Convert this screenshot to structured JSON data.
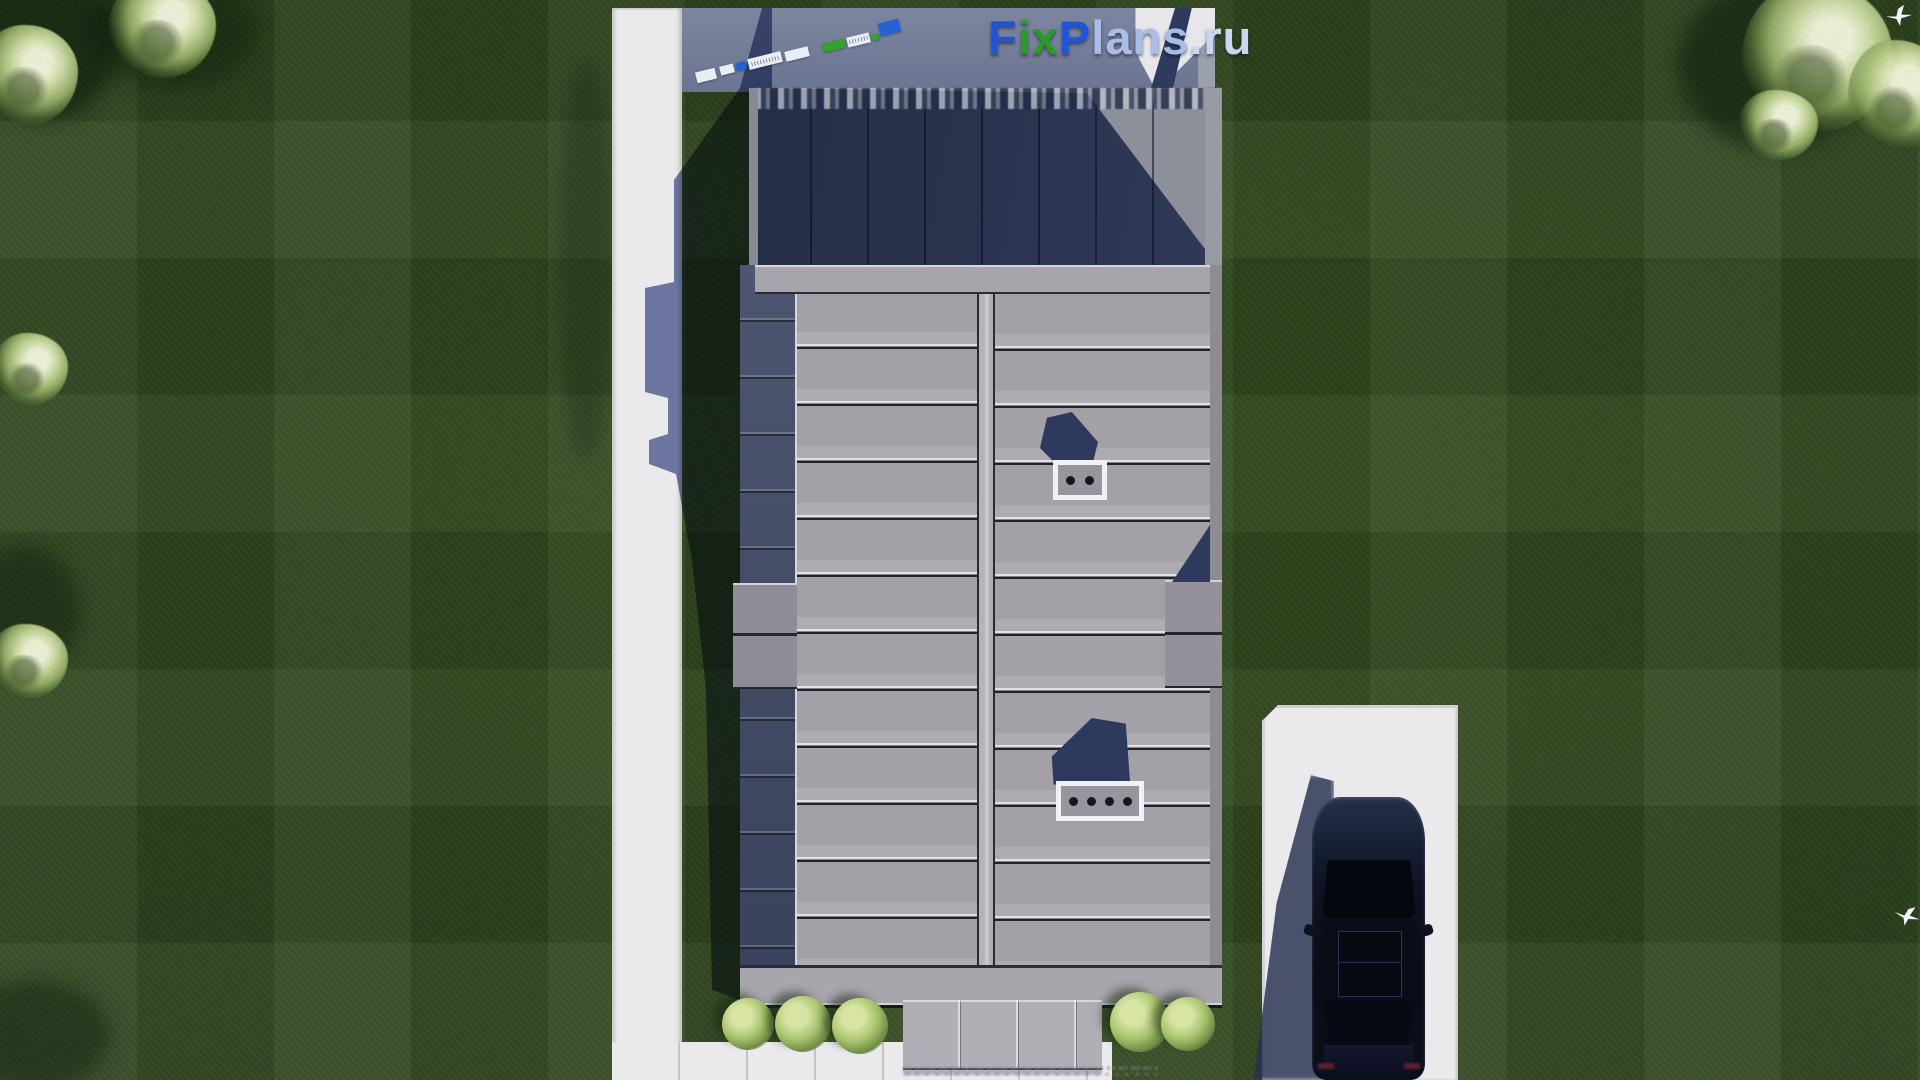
{
  "scene": {
    "description": "Aerial top-down 3D architectural render: modern rectangular house with gray standing-seam metal roof and dark shaded flat section, white garden path on the left, front walkway with bushes at the bottom, concrete driveway with a dark parked car at bottom right, manicured dark-green lawn with light ornamental trees and two white birds",
    "objects": [
      "lawn",
      "garden-path",
      "house-roof",
      "flat-roof-section",
      "chimney-vents",
      "porch-canopy",
      "bushes",
      "driveway",
      "car",
      "trees",
      "birds",
      "brand-watermark",
      "scale-strip"
    ]
  },
  "watermark": {
    "brand": "FixPlans.ru",
    "segments": [
      {
        "text": "F",
        "color": "#1f55d6"
      },
      {
        "text": "ix",
        "color": "#2a9a28"
      },
      {
        "text": "P",
        "color": "#1f55d6"
      },
      {
        "text": "lans",
        "color": "#a9bde6"
      },
      {
        "text": ".ru",
        "color": "#ccd6ee"
      }
    ]
  },
  "house": {
    "roof_row_pitch_px": 57,
    "chimney_vents_small": 2,
    "chimney_vents_large": 4,
    "canopy_seams": 3
  },
  "colors": {
    "lawn": "#2f4520",
    "path_concrete": "#eae9ec",
    "roof_panels": "#a3a0a8",
    "roof_seam_light": "#e3e1e5",
    "roof_seam_dark": "#22222c",
    "flat_roof_shadow": "#2b3450",
    "cast_shadow": "#3b4768",
    "car_body": "#0c101e",
    "bushes": "#a7c36c",
    "logo_blue": "#1f55d6",
    "logo_green": "#2a9a28"
  }
}
